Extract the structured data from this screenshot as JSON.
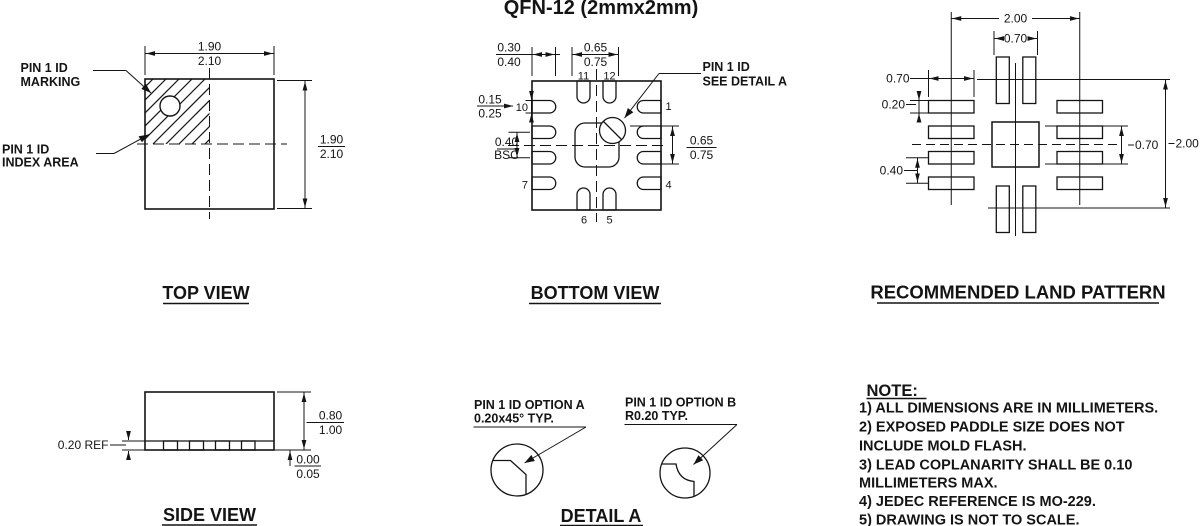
{
  "page": {
    "title": "QFN-12 (2mmx2mm)",
    "ink": "#141414",
    "background": "#ffffff"
  },
  "top_view": {
    "title": "TOP VIEW",
    "marking_label": [
      "PIN 1 ID",
      "MARKING"
    ],
    "index_label": [
      "PIN 1 ID",
      "INDEX AREA"
    ],
    "dim_width": [
      "1.90",
      "2.10"
    ],
    "dim_height": [
      "1.90",
      "2.10"
    ]
  },
  "bottom_view": {
    "title": "BOTTOM VIEW",
    "pin1_label": [
      "PIN 1 ID",
      "SEE DETAIL A"
    ],
    "dims": {
      "lead_length": [
        "0.30",
        "0.40"
      ],
      "top_pads_span": [
        "0.65",
        "0.75"
      ],
      "lead_width": [
        "0.15",
        "0.25"
      ],
      "pitch": [
        "0.40",
        "BSC"
      ],
      "right_span": [
        "0.65",
        "0.75"
      ]
    },
    "pins": {
      "p1": "1",
      "p4": "4",
      "p5": "5",
      "p6": "6",
      "p7": "7",
      "p10": "10",
      "p11": "11",
      "p12": "12"
    }
  },
  "land_pattern": {
    "title": "RECOMMENDED LAND PATTERN",
    "dims": {
      "span_top": "2.00",
      "top_pads": "0.70",
      "pad_length": "0.70",
      "pad_width": "0.20",
      "pitch": "0.40",
      "mid_span": "0.70",
      "span_right": "2.00"
    }
  },
  "side_view": {
    "title": "SIDE VIEW",
    "lead_thickness": "0.20 REF",
    "dim_height": [
      "0.80",
      "1.00"
    ],
    "dim_standoff": [
      "0.00",
      "0.05"
    ]
  },
  "detail_a": {
    "title": "DETAIL A",
    "option_a": [
      "PIN 1 ID OPTION A",
      "0.20x45° TYP."
    ],
    "option_b": [
      "PIN 1 ID OPTION B",
      "R0.20 TYP."
    ]
  },
  "notes": {
    "title": "NOTE:",
    "lines": [
      "1) ALL DIMENSIONS ARE IN MILLIMETERS.",
      "2) EXPOSED PADDLE SIZE DOES NOT",
      "INCLUDE MOLD FLASH.",
      "3) LEAD COPLANARITY SHALL BE 0.10",
      "MILLIMETERS MAX.",
      "4) JEDEC REFERENCE IS MO-229.",
      "5) DRAWING IS NOT TO SCALE."
    ]
  }
}
